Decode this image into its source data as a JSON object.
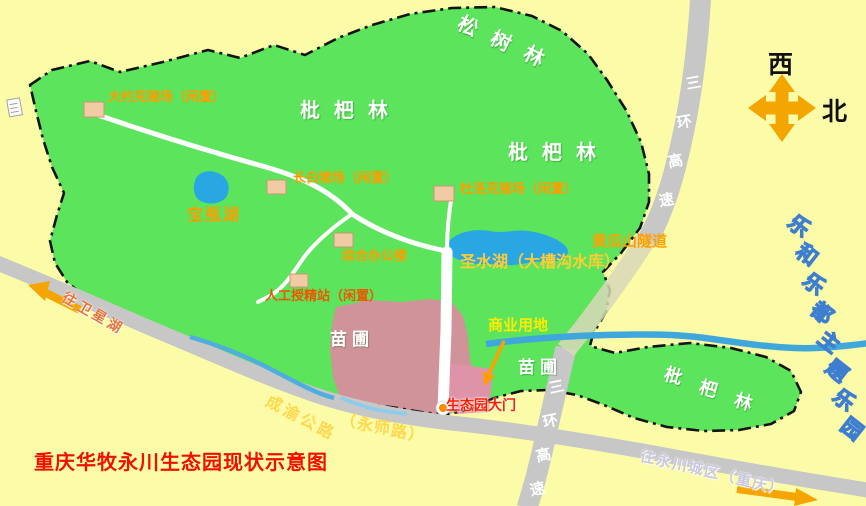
{
  "title": "重庆华牧永川生态园现状示意图",
  "compass": {
    "west": "西",
    "north": "北"
  },
  "forests": {
    "pine": "松树林",
    "loquat_top": "枇杷林",
    "loquat_mid": "枇杷林",
    "loquat_bottom": "枇杷林"
  },
  "water": {
    "baoping_lake": "宝瓶湖",
    "shengshui_lake": "圣水湖（大槽沟水库）"
  },
  "facilities": {
    "yorkshire_farm": "大约克猪场（闲置）",
    "landrace_farm": "长白猪场（闲置）",
    "duroc_farm": "杜洛克猪场（闲置）",
    "office_building": "综合办公楼",
    "insemination_station": "人工授精站（闲置）",
    "gate": "生态园大门"
  },
  "land_use": {
    "commercial": "商业用地",
    "nursery_left": "苗圃",
    "nursery_right": "苗圃"
  },
  "roads": {
    "ring_expressway_upper": "三环高速",
    "ring_expressway_lower": "三环高速",
    "huanggua_tunnel": "黄瓜山隧道",
    "chengyu_highway": "成渝公路",
    "yongshi_road": "（永师路）",
    "to_weixing_lake": "往卫星湖",
    "to_yongchuan_city": "往永川城区（重庆）"
  },
  "landmarks": {
    "theme_park": "乐和乐都主题乐园"
  },
  "colors": {
    "background": "#FCFCA8",
    "park_green": "#5CE45C",
    "road_gray": "#C7C7C7",
    "water_blue": "#29A7E3",
    "commercial_pink": "#CF9399",
    "gate_pink": "#DE93A8",
    "building_tan": "#F1CBA4",
    "label_orange": "#FF9D00",
    "label_red": "#EE1100",
    "compass_orange": "#F4A600",
    "theme_park_blue": "#3E7ED0"
  }
}
